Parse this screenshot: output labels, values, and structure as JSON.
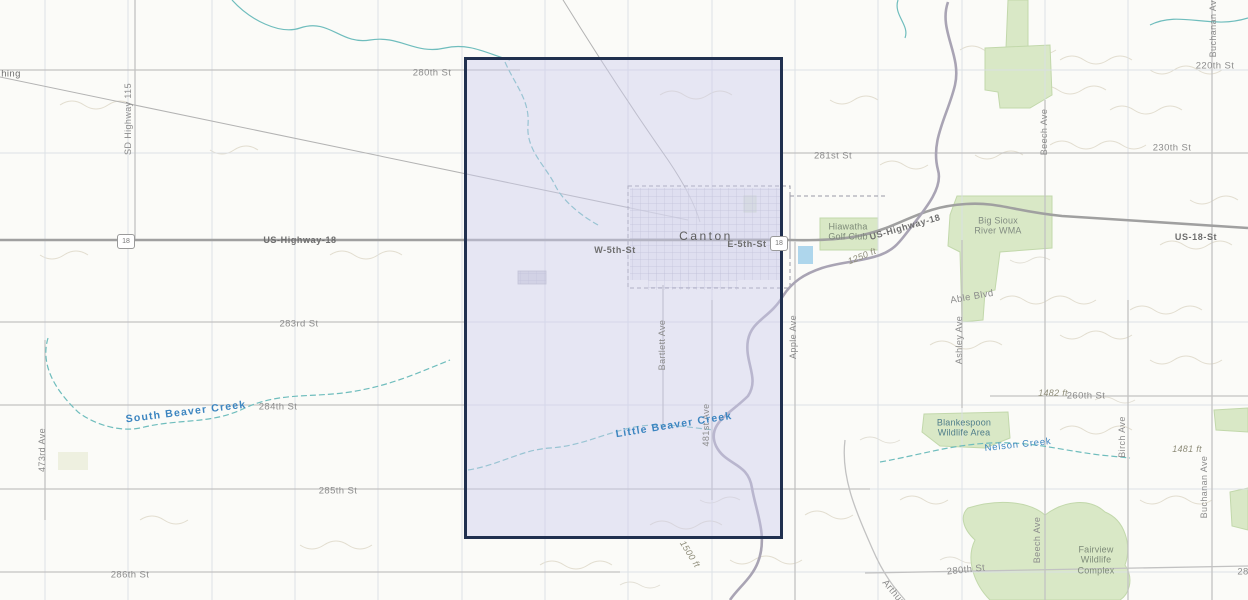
{
  "map": {
    "description": "Topographic web map of Canton, South Dakota vicinity with a highlighted rectangular extent",
    "selection": {
      "name": "highlighted-extent"
    },
    "shields": {
      "us18_left": "18",
      "us18_right": "18"
    },
    "colors": {
      "selection_border": "#20304f",
      "selection_fill": "#cdcdee",
      "water_line": "#6fbdbd",
      "water_label": "#3c85c0",
      "green_area": "#d9e8c6",
      "road": "#c2c2c2",
      "highway": "#a0a0a0",
      "label_gray": "#8c8c8c",
      "river": "#a9a4b4",
      "pond": "#aed6ec"
    },
    "labels": {
      "worthing_partial": "hing",
      "st280_nw": "280th St",
      "st281": "281st St",
      "st283": "283rd St",
      "st284": "284th St",
      "st285": "285th St",
      "st286": "286th St",
      "st220": "220th St",
      "st230": "230th St",
      "st260": "260th St",
      "st280_se": "280th St",
      "st28_edge": "28",
      "sd_hwy115": "SD Highway 115",
      "us_hwy18_w": "US-Highway-18",
      "us_hwy18_e": "US-Highway-18",
      "us18_st": "US-18-St",
      "w5th": "W-5th-St",
      "e5th": "E-5th-St",
      "canton": "Canton",
      "hiawatha": "Hiawatha Golf Club",
      "big_sioux_wma": "Big Sioux River WMA",
      "blankespoon": "Blankespoon Wildlife Area",
      "fairview": "Fairview Wildlife Complex",
      "nelson_creek": "Nelson Creek",
      "south_beaver_creek": "South Beaver Creek",
      "little_beaver_creek": "Little Beaver Creek",
      "able_blvd": "Able Blvd",
      "apple_ave": "Apple Ave",
      "ashley_ave": "Ashley Ave",
      "beech_ave_n": "Beech Ave",
      "beech_ave_s": "Beech Ave",
      "birch_ave": "Birch Ave",
      "buchanan_ave_n": "Buchanan Ave",
      "buchanan_ave_s": "Buchanan Ave",
      "bartlett_ave": "Bartlett Ave",
      "ave473": "473rd Ave",
      "ave481": "481st Ave",
      "arthur_partial": "Arthur",
      "elev1250": "1250 ft",
      "elev1482": "1482 ft",
      "elev1481": "1481 ft",
      "elev1500": "1500 ft"
    }
  }
}
